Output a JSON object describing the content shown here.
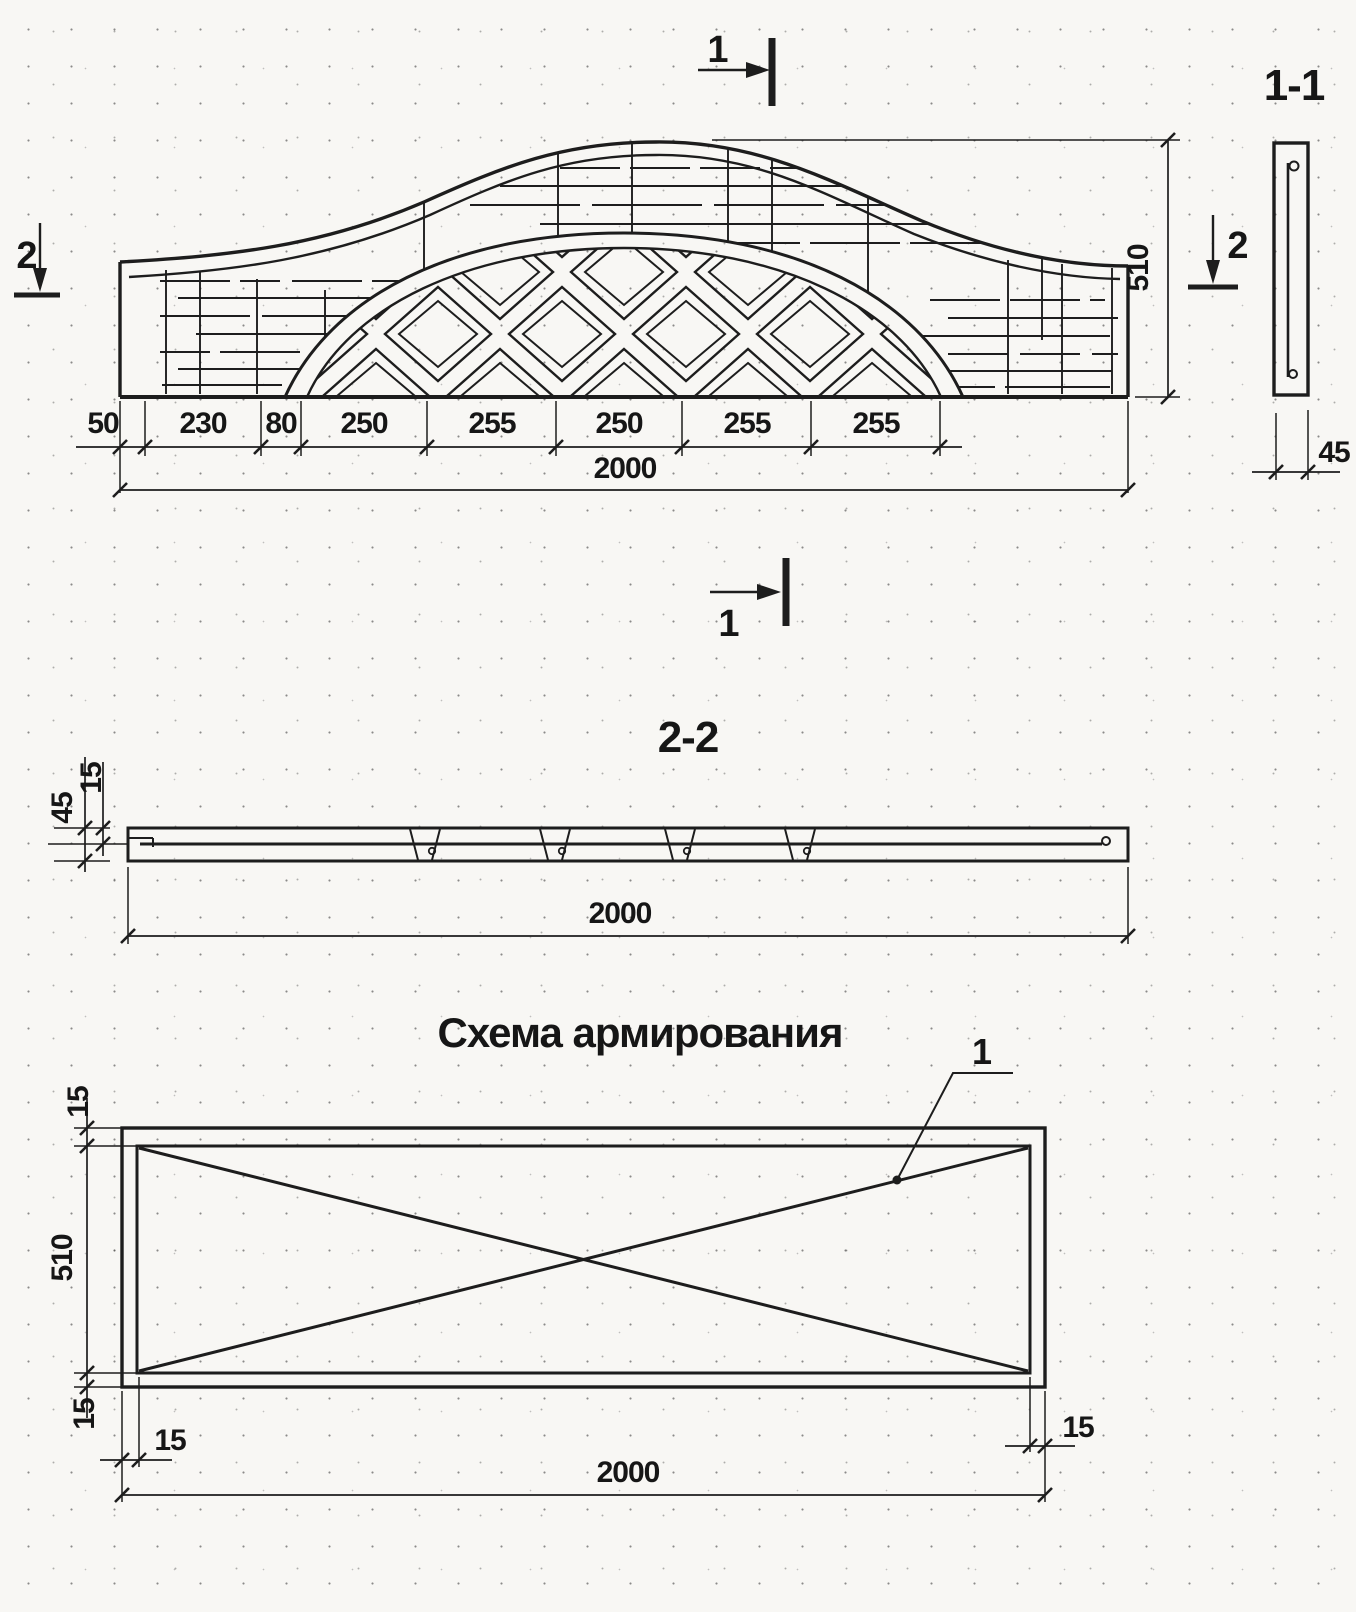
{
  "sheet": {
    "paper_color": "#f8f7f4",
    "ink_color": "#1d1d1d"
  },
  "elevation": {
    "marker_top_label": "1",
    "marker_bottom_label": "1",
    "marker_left_label": "2",
    "marker_right_label": "2",
    "dim_chain": [
      "50",
      "230",
      "80",
      "250",
      "255",
      "250",
      "255",
      "255"
    ],
    "dim_total": "2000",
    "dim_height": "510"
  },
  "section_1_1": {
    "title": "1-1",
    "dim_width": "45"
  },
  "section_2_2": {
    "title": "2-2",
    "dim_top_cover": "15",
    "dim_thickness": "45",
    "dim_length": "2000"
  },
  "reinforcement_scheme": {
    "title": "Схема армирования",
    "bar_callout": "1",
    "dim_side_top": "15",
    "dim_side_height": "510",
    "dim_side_bottom": "15",
    "dim_bottom_left": "15",
    "dim_bottom_right": "15",
    "dim_bottom_total": "2000"
  }
}
